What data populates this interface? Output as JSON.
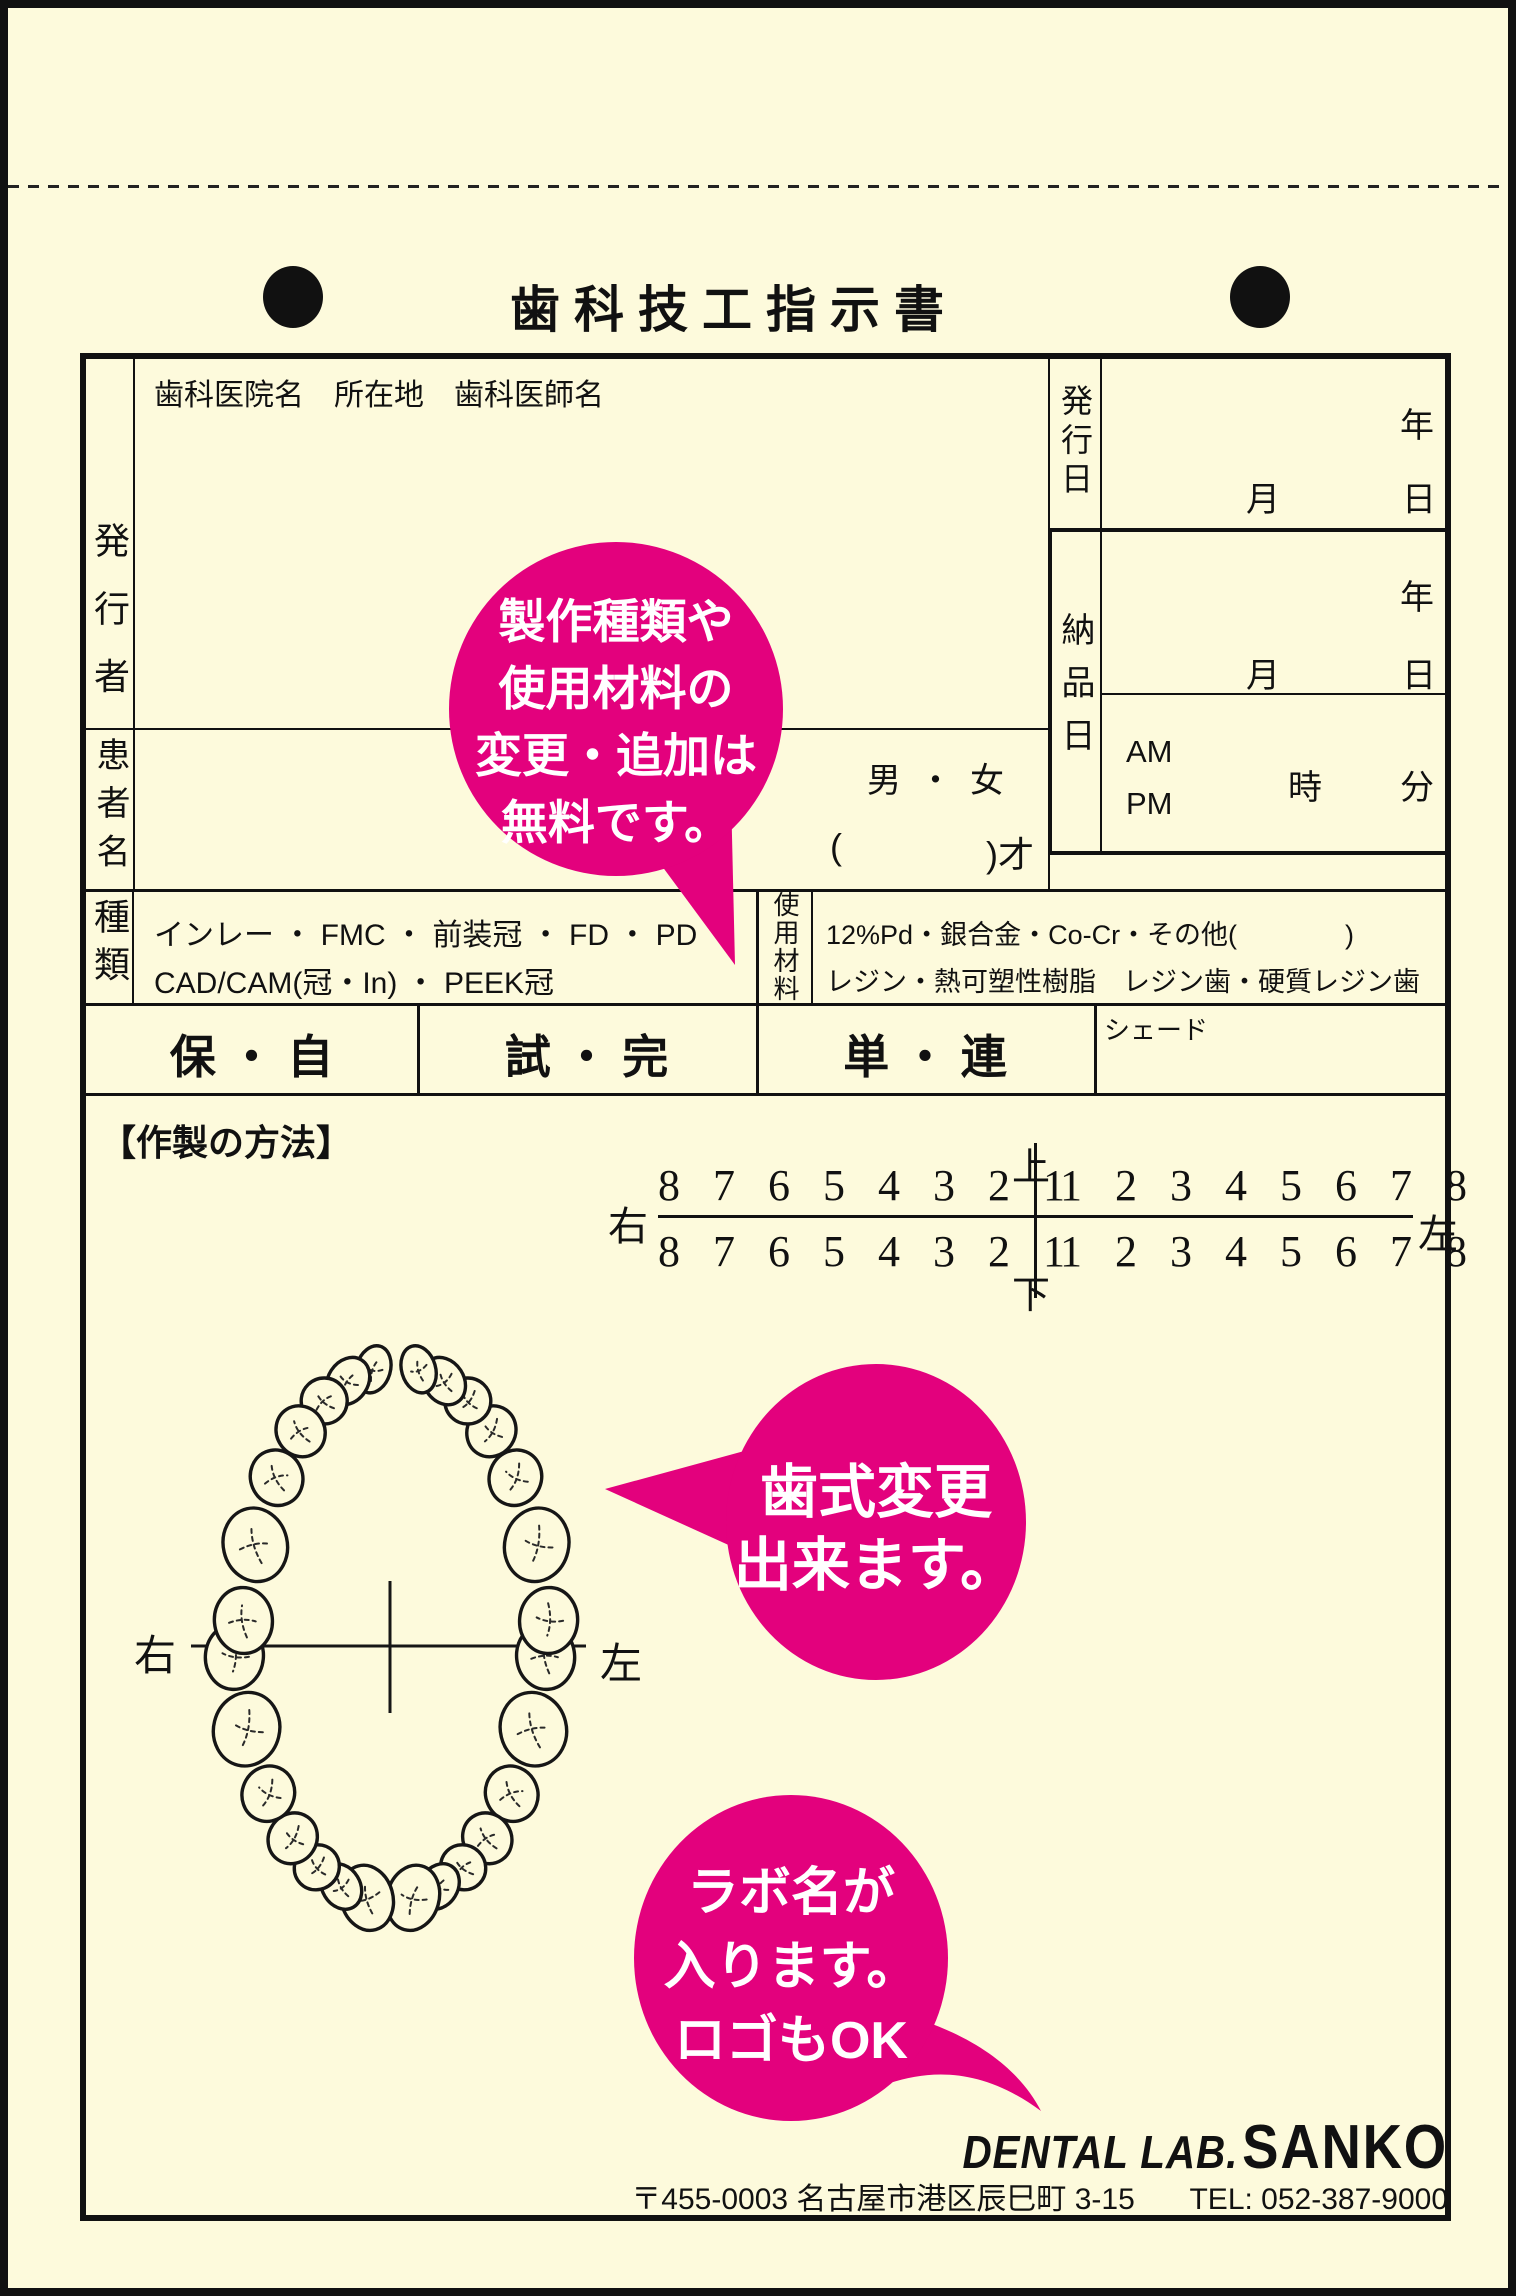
{
  "colors": {
    "pink": "#E3017D",
    "cream": "#FDFADC",
    "ink": "#111111"
  },
  "page": {
    "title": "歯科技工指示書"
  },
  "issuer": {
    "label": "発行者",
    "header": "歯科医院名　所在地　歯科医師名"
  },
  "patient": {
    "label": "患者名",
    "sex": "男 ・ 女",
    "age_open": "(",
    "age_close": ")才"
  },
  "issue_date": {
    "label": "発行日",
    "year": "年",
    "month": "月",
    "day": "日"
  },
  "delivery": {
    "label": "納品日",
    "year": "年",
    "month": "月",
    "day": "日",
    "am": "AM",
    "pm": "PM",
    "hour": "時",
    "minute": "分"
  },
  "category": {
    "label": "種類",
    "line1": "インレー ・ FMC ・ 前装冠 ・ FD ・ PD",
    "line2": "CAD/CAM(冠・In) ・ PEEK冠"
  },
  "material": {
    "label": "使用材料",
    "line1": "12%Pd・銀合金・Co-Cr・その他(　　　　)",
    "line2": "レジン・熱可塑性樹脂　レジン歯・硬質レジン歯"
  },
  "options": {
    "insurance": "保 ・ 自",
    "trial": "試 ・ 完",
    "unit": "単 ・ 連",
    "shade": "シェード"
  },
  "method": {
    "label": "【作製の方法】"
  },
  "tooth_chart": {
    "up": "上",
    "down": "下",
    "right": "右",
    "left": "左",
    "upper_right": "8 7 6 5 4 3 2 1",
    "upper_left": "1 2 3 4 5 6 7 8",
    "lower_right": "8 7 6 5 4 3 2 1",
    "lower_left": "1 2 3 4 5 6 7 8"
  },
  "diagram": {
    "right": "右",
    "left": "左"
  },
  "bubbles": {
    "b1": {
      "lines": [
        "製作種類や",
        "使用材料の",
        "変更・追加は",
        "無料です。"
      ]
    },
    "b2": {
      "lines": [
        "歯式変更",
        "出来ます。"
      ]
    },
    "b3": {
      "lines": [
        "ラボ名が",
        "入ります。",
        "ロゴもOK"
      ]
    }
  },
  "footer": {
    "brand_prefix": "DENTAL LAB.",
    "brand_name": "SANKO",
    "address": "〒455-0003 名古屋市港区辰巳町 3-15",
    "tel": "TEL: 052-387-9000"
  }
}
